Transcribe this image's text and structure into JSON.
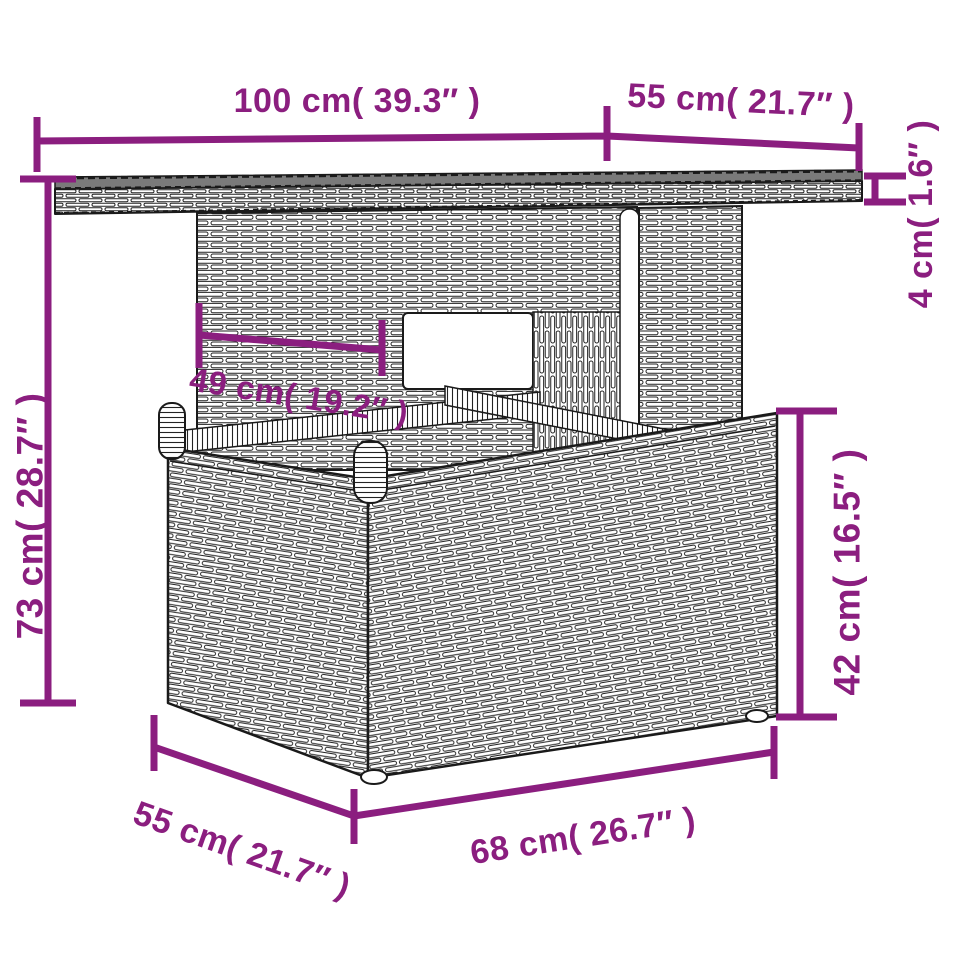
{
  "diagram": {
    "subject": "poly rattan garden table with glass top",
    "style": {
      "accent": "#8b1e7f",
      "ink": "#1a1a1a",
      "glass_gray": "#7a7a7a",
      "background": "#ffffff"
    },
    "labels": {
      "top_width": "100 cm( 39.3″ )",
      "top_depth": "55 cm( 21.7″ )",
      "top_thickness": "4 cm( 1.6″ )",
      "inner_width": "49 cm( 19.2″ )",
      "total_height": "73 cm( 28.7″ )",
      "base_height": "42 cm( 16.5″ )",
      "base_depth": "55 cm( 21.7″ )",
      "base_width": "68 cm( 26.7″ )"
    }
  }
}
